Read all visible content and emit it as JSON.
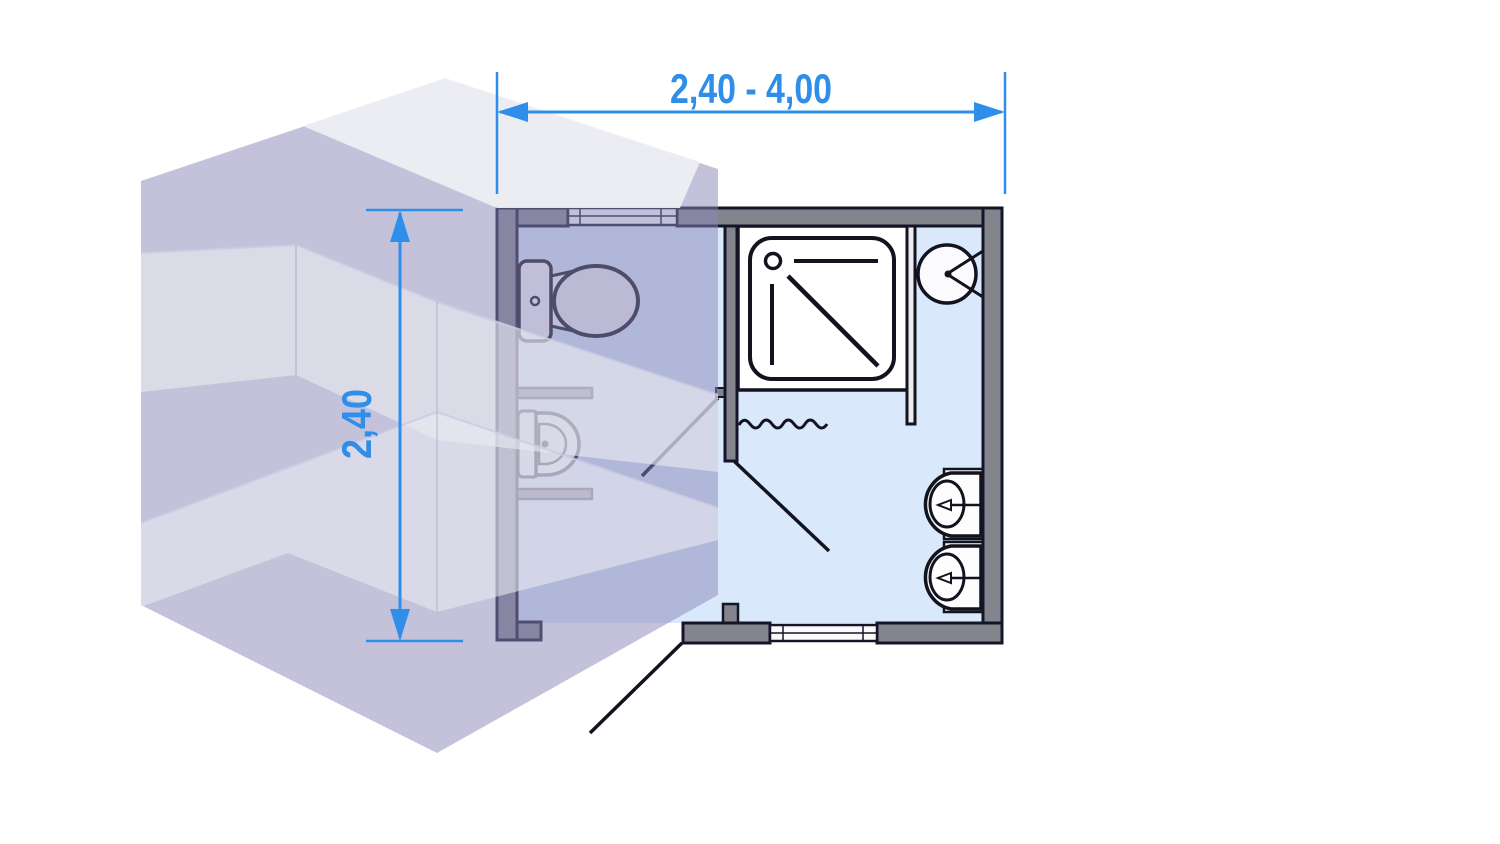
{
  "title": "Bathroom module diagram: isometric translucent volume with bathroom floor plan",
  "dimensions": {
    "width": {
      "label": "2,40 - 4,00",
      "orientation": "horizontal",
      "position": "top"
    },
    "depth": {
      "label": "2,40",
      "orientation": "vertical",
      "position": "left"
    }
  },
  "colors": {
    "dimension_blue": "#2E8EE9",
    "wall_fill": "#84848C",
    "wall_outline": "#15152A",
    "floor_blue": "#D9E8FA",
    "cube_lavender": "#8A85B8",
    "cube_white_band": "#E9EAF1",
    "fixture_stroke": "#13131F",
    "fixture_fill": "#F8F8FA"
  },
  "cube": {
    "type": "isometric-translucent-module",
    "stories": 2
  },
  "plan": {
    "rooms": [
      {
        "name": "wc-compartment",
        "fixtures": [
          "toilet",
          "bidet"
        ]
      },
      {
        "name": "main-bathroom",
        "fixtures": [
          "shower-tray",
          "round-washbasin",
          "washbasin",
          "washbasin"
        ]
      }
    ],
    "openings": [
      "window-top-wall",
      "window-bottom-wall",
      "wc-door",
      "inner-door",
      "entry-door"
    ],
    "symbols": [
      "shower-curtain-wave",
      "door-swing-lines",
      "shower-drain",
      "taps"
    ]
  }
}
